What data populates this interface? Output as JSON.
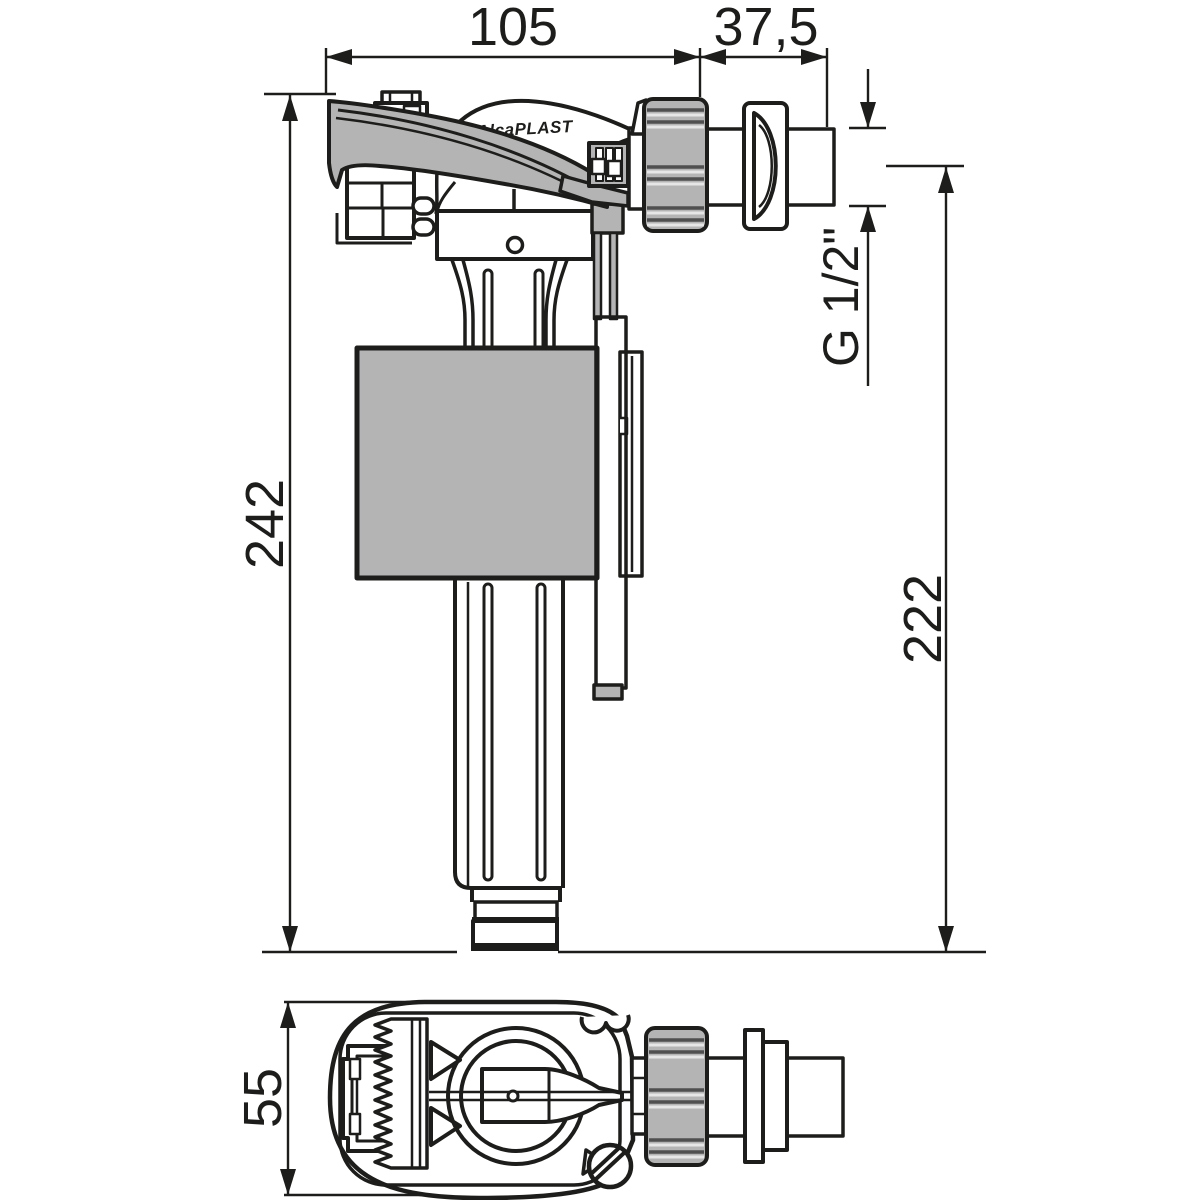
{
  "brand": {
    "logo": "AlcaPLAST"
  },
  "dimensions": {
    "width_top": "105",
    "thread_length": "37,5",
    "overall_height": "242",
    "height_axis_to_bottom": "222",
    "thread_size": "G 1/2\"",
    "body_depth": "55"
  },
  "colors": {
    "line": "#1d1d1b",
    "part_gray": "#b4b4b4",
    "background": "#ffffff"
  }
}
